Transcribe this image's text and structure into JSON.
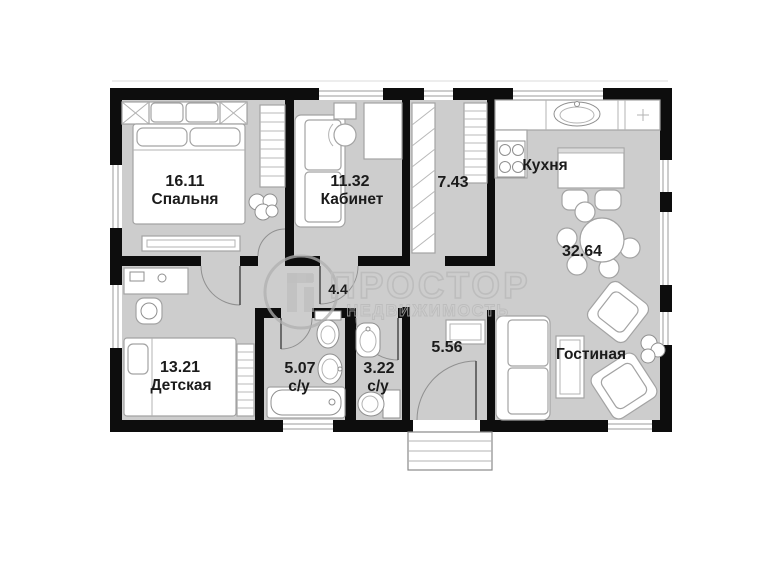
{
  "watermark": {
    "brand": "ПРОСТОР",
    "subtitle": "НЕДВИЖИМОСТЬ"
  },
  "rooms": {
    "bedroom": {
      "area": "16.11",
      "name": "Спальня"
    },
    "office": {
      "area": "11.32",
      "name": "Кабинет"
    },
    "corridor": {
      "area": "7.43"
    },
    "kitchen": {
      "name": "Кухня"
    },
    "kitchen_living": {
      "area": "32.64"
    },
    "living": {
      "name": "Гостиная"
    },
    "hallway": {
      "area": "4.4"
    },
    "children": {
      "area": "13.21",
      "name": "Детская"
    },
    "bathroom_big": {
      "area": "5.07",
      "name": "с/у"
    },
    "bathroom_small": {
      "area": "3.22",
      "name": "с/у"
    },
    "entry": {
      "area": "5.56"
    }
  },
  "colors": {
    "wall": "#0d0d0d",
    "floor": "#cdcdcd",
    "furniture_outline": "#a3a3a3",
    "label": "#1b1b1b",
    "watermark": "#b8b8b8",
    "background": "#ffffff"
  }
}
